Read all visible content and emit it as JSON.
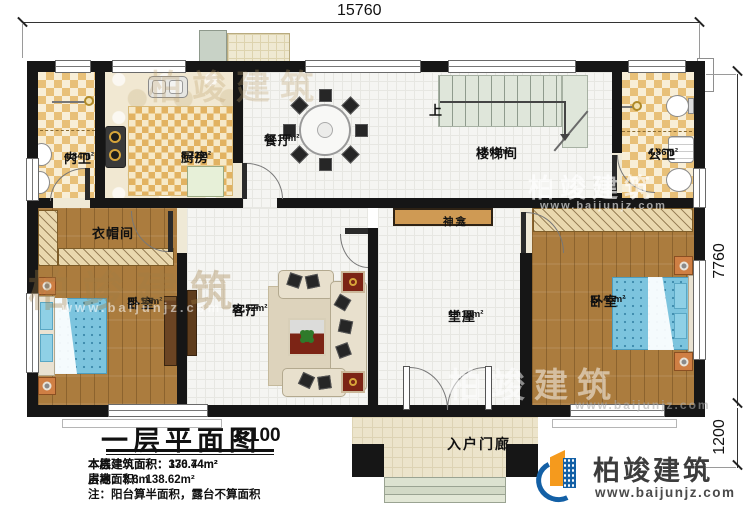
{
  "dimensions": {
    "width_top": "15760",
    "depth_right": "7760",
    "porch_depth": "1200"
  },
  "stairs": {
    "up_label": "上"
  },
  "rooms": {
    "inner_bath": {
      "name": "内卫",
      "area": "4.84m²"
    },
    "kitchen": {
      "name": "厨房",
      "area": "8.22m²"
    },
    "dining": {
      "name": "餐厅",
      "area": "10.10m²"
    },
    "stairwell": {
      "name": "楼梯间",
      "area": "13.69m²"
    },
    "public_bath": {
      "name": "公卫",
      "area": "4.86m²"
    },
    "cloakroom": {
      "name": "衣帽间"
    },
    "bedroom_left": {
      "name": "卧室",
      "area": "15.19m²"
    },
    "living": {
      "name": "客厅",
      "area": "19.52m²"
    },
    "main_hall": {
      "name": "堂屋",
      "area": "15.19m²"
    },
    "bedroom_right": {
      "name": "卧室",
      "area": "17.45m²"
    },
    "shrine": {
      "name": "神龛"
    },
    "porch": {
      "name": "入户门廊"
    }
  },
  "title_block": {
    "title": "一层平面图",
    "scale": "1:100",
    "stats": [
      {
        "label": "本层建筑面积：",
        "value": "130.74m²"
      },
      {
        "label": "本栋建筑面积：",
        "value": "376.44m²"
      },
      {
        "label": "占地面积：",
        "value": "138.62m²"
      },
      {
        "label": "层高：",
        "value": "3.6m"
      }
    ],
    "note": "注：阳台算半面积，露台不算面积"
  },
  "logo": {
    "company": "柏竣建筑",
    "website": "www.baijunjz.com"
  },
  "watermark": {
    "brand": "柏竣建筑",
    "site": "www.baijunjz.com"
  },
  "colors": {
    "wall": "#161616",
    "checker": "#e8c078",
    "wood": "#ab7c3e",
    "bed": "#7cc4de",
    "logo_blue": "#1360a6",
    "logo_orange": "#f59a1d"
  }
}
